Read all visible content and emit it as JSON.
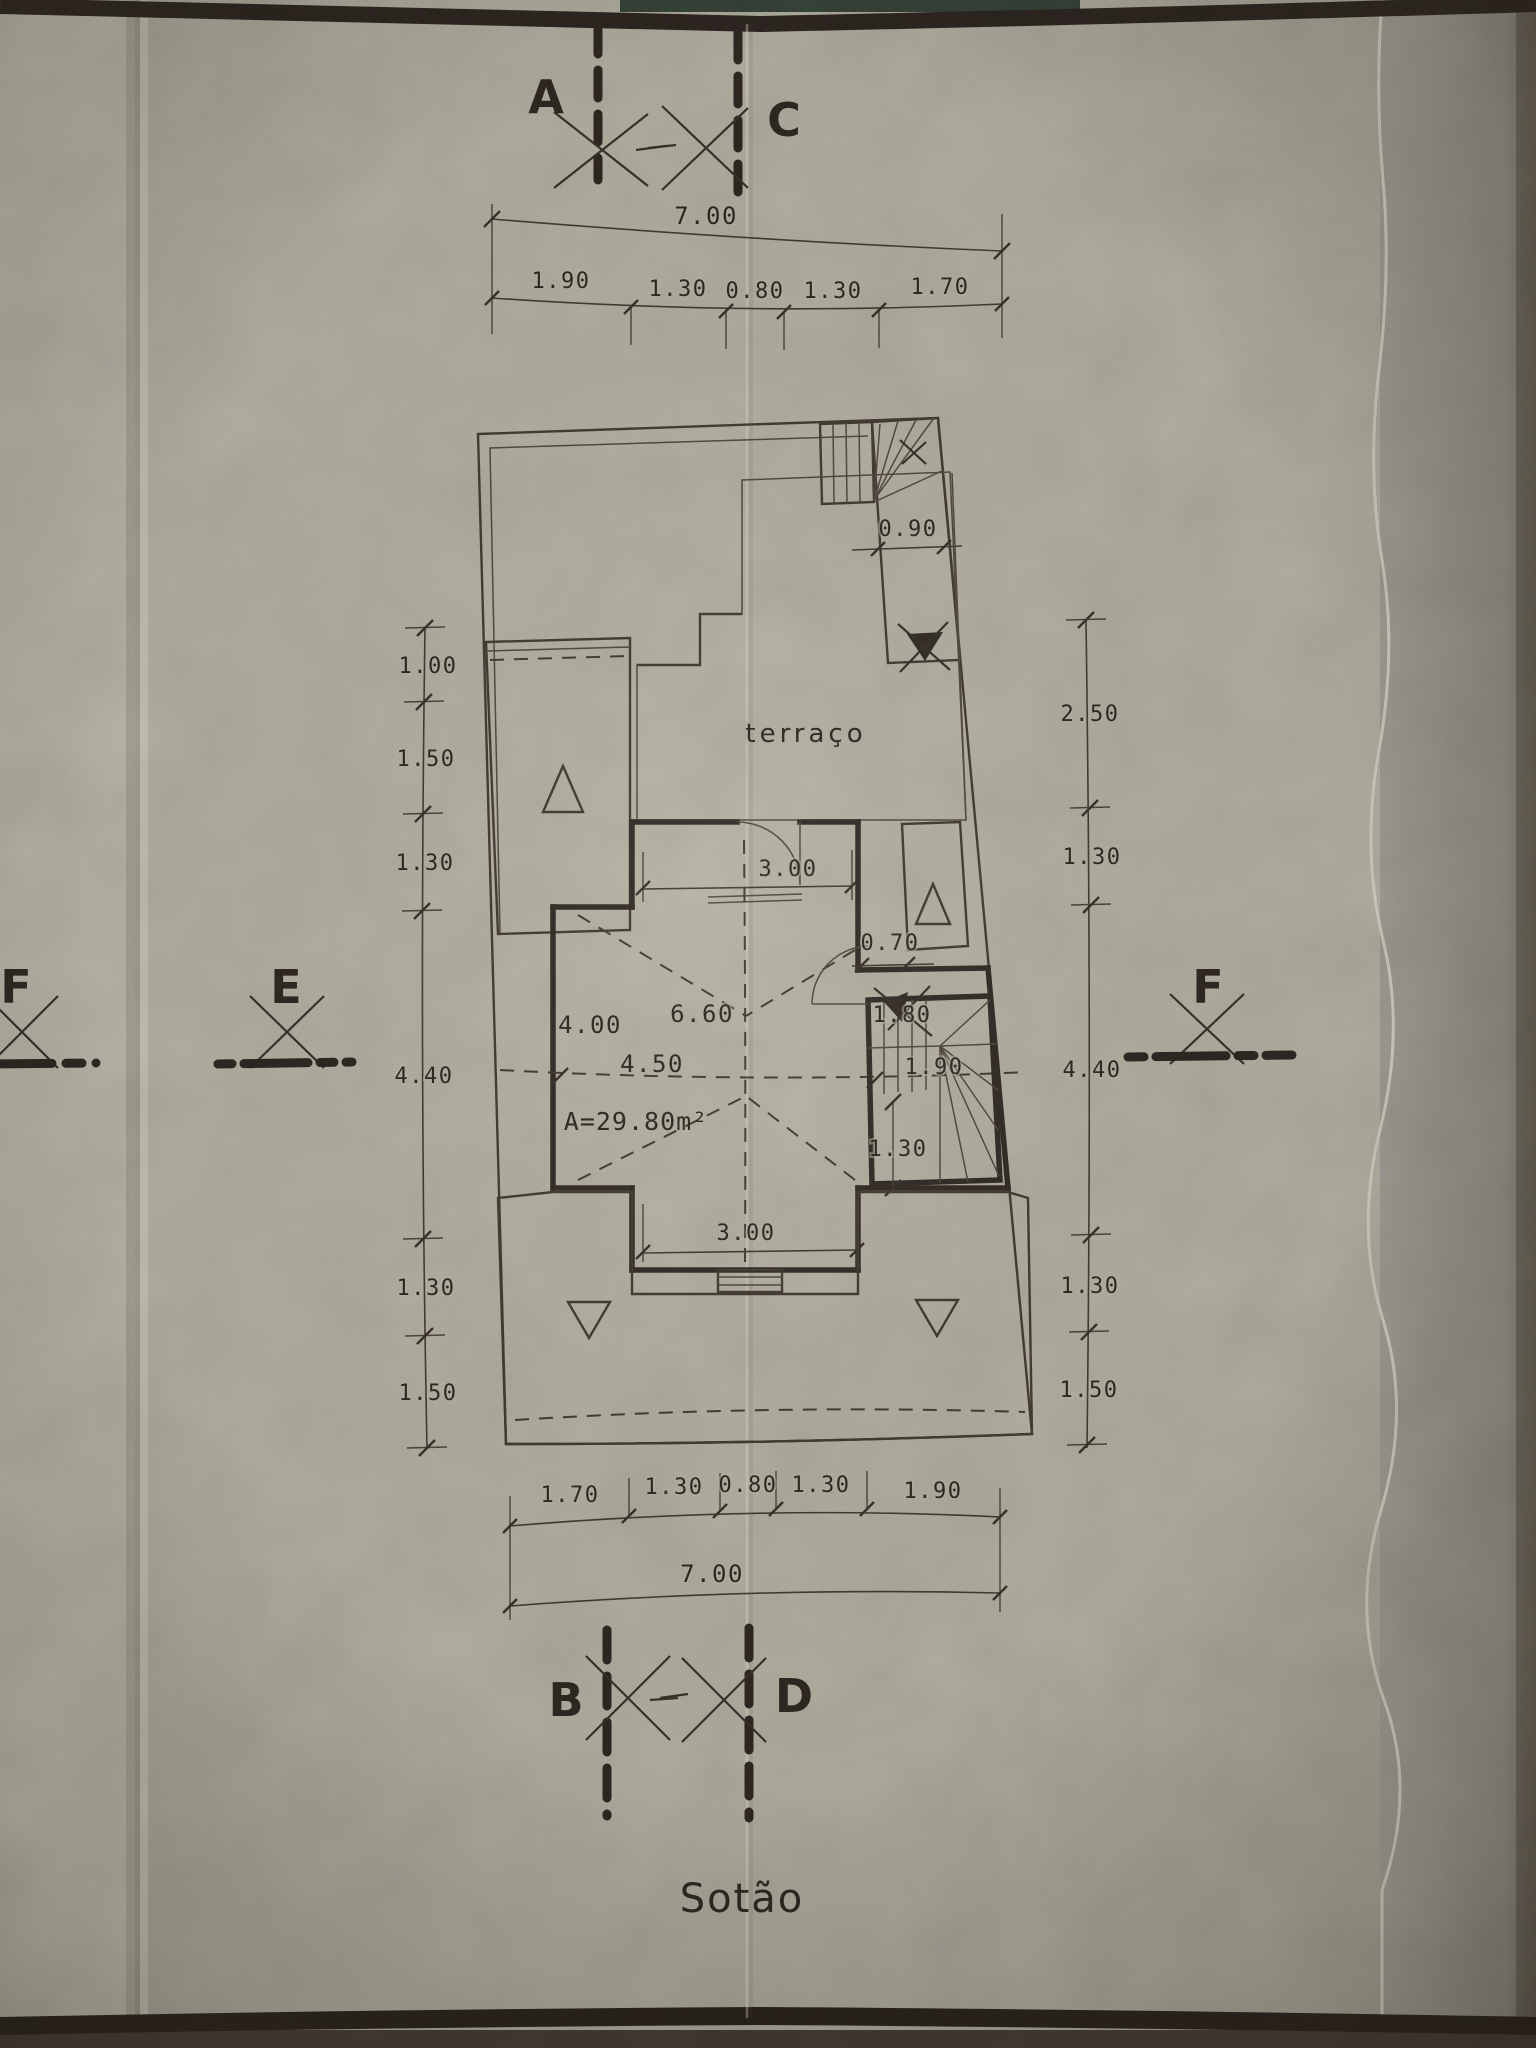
{
  "page": {
    "caption": "Sotão"
  },
  "section_markers": {
    "a": "A",
    "b": "B",
    "c": "C",
    "d": "D",
    "e": "E",
    "f_left": "F",
    "f_right": "F"
  },
  "dimensions": {
    "top": {
      "total": "7.00",
      "segments": [
        "1.90",
        "1.30",
        "0.80",
        "1.30",
        "1.70"
      ]
    },
    "bottom": {
      "total": "7.00",
      "segments": [
        "1.70",
        "1.30",
        "0.80",
        "1.30",
        "1.90"
      ]
    },
    "left": {
      "segments": [
        "1.00",
        "1.50",
        "1.30",
        "4.40",
        "1.30",
        "1.50"
      ]
    },
    "right": {
      "segments": [
        "2.50",
        "1.30",
        "4.40",
        "1.30",
        "1.50"
      ]
    }
  },
  "plan": {
    "terrace_label": "terraço",
    "area_label": "A=29.80m²",
    "dims": {
      "stair_run": "0.90",
      "top_opening": "3.00",
      "right_offset": "0.70",
      "ridge_length": "6.60",
      "left_width": "4.00",
      "room_width": "4.50",
      "stair_width": "1.80",
      "stair_depth": "1.90",
      "right_wing": "1.30",
      "bottom_opening": "3.00"
    }
  },
  "colors": {
    "ink": "#38302a",
    "paper": "#bdbaab",
    "album_page": "#a6a399"
  }
}
